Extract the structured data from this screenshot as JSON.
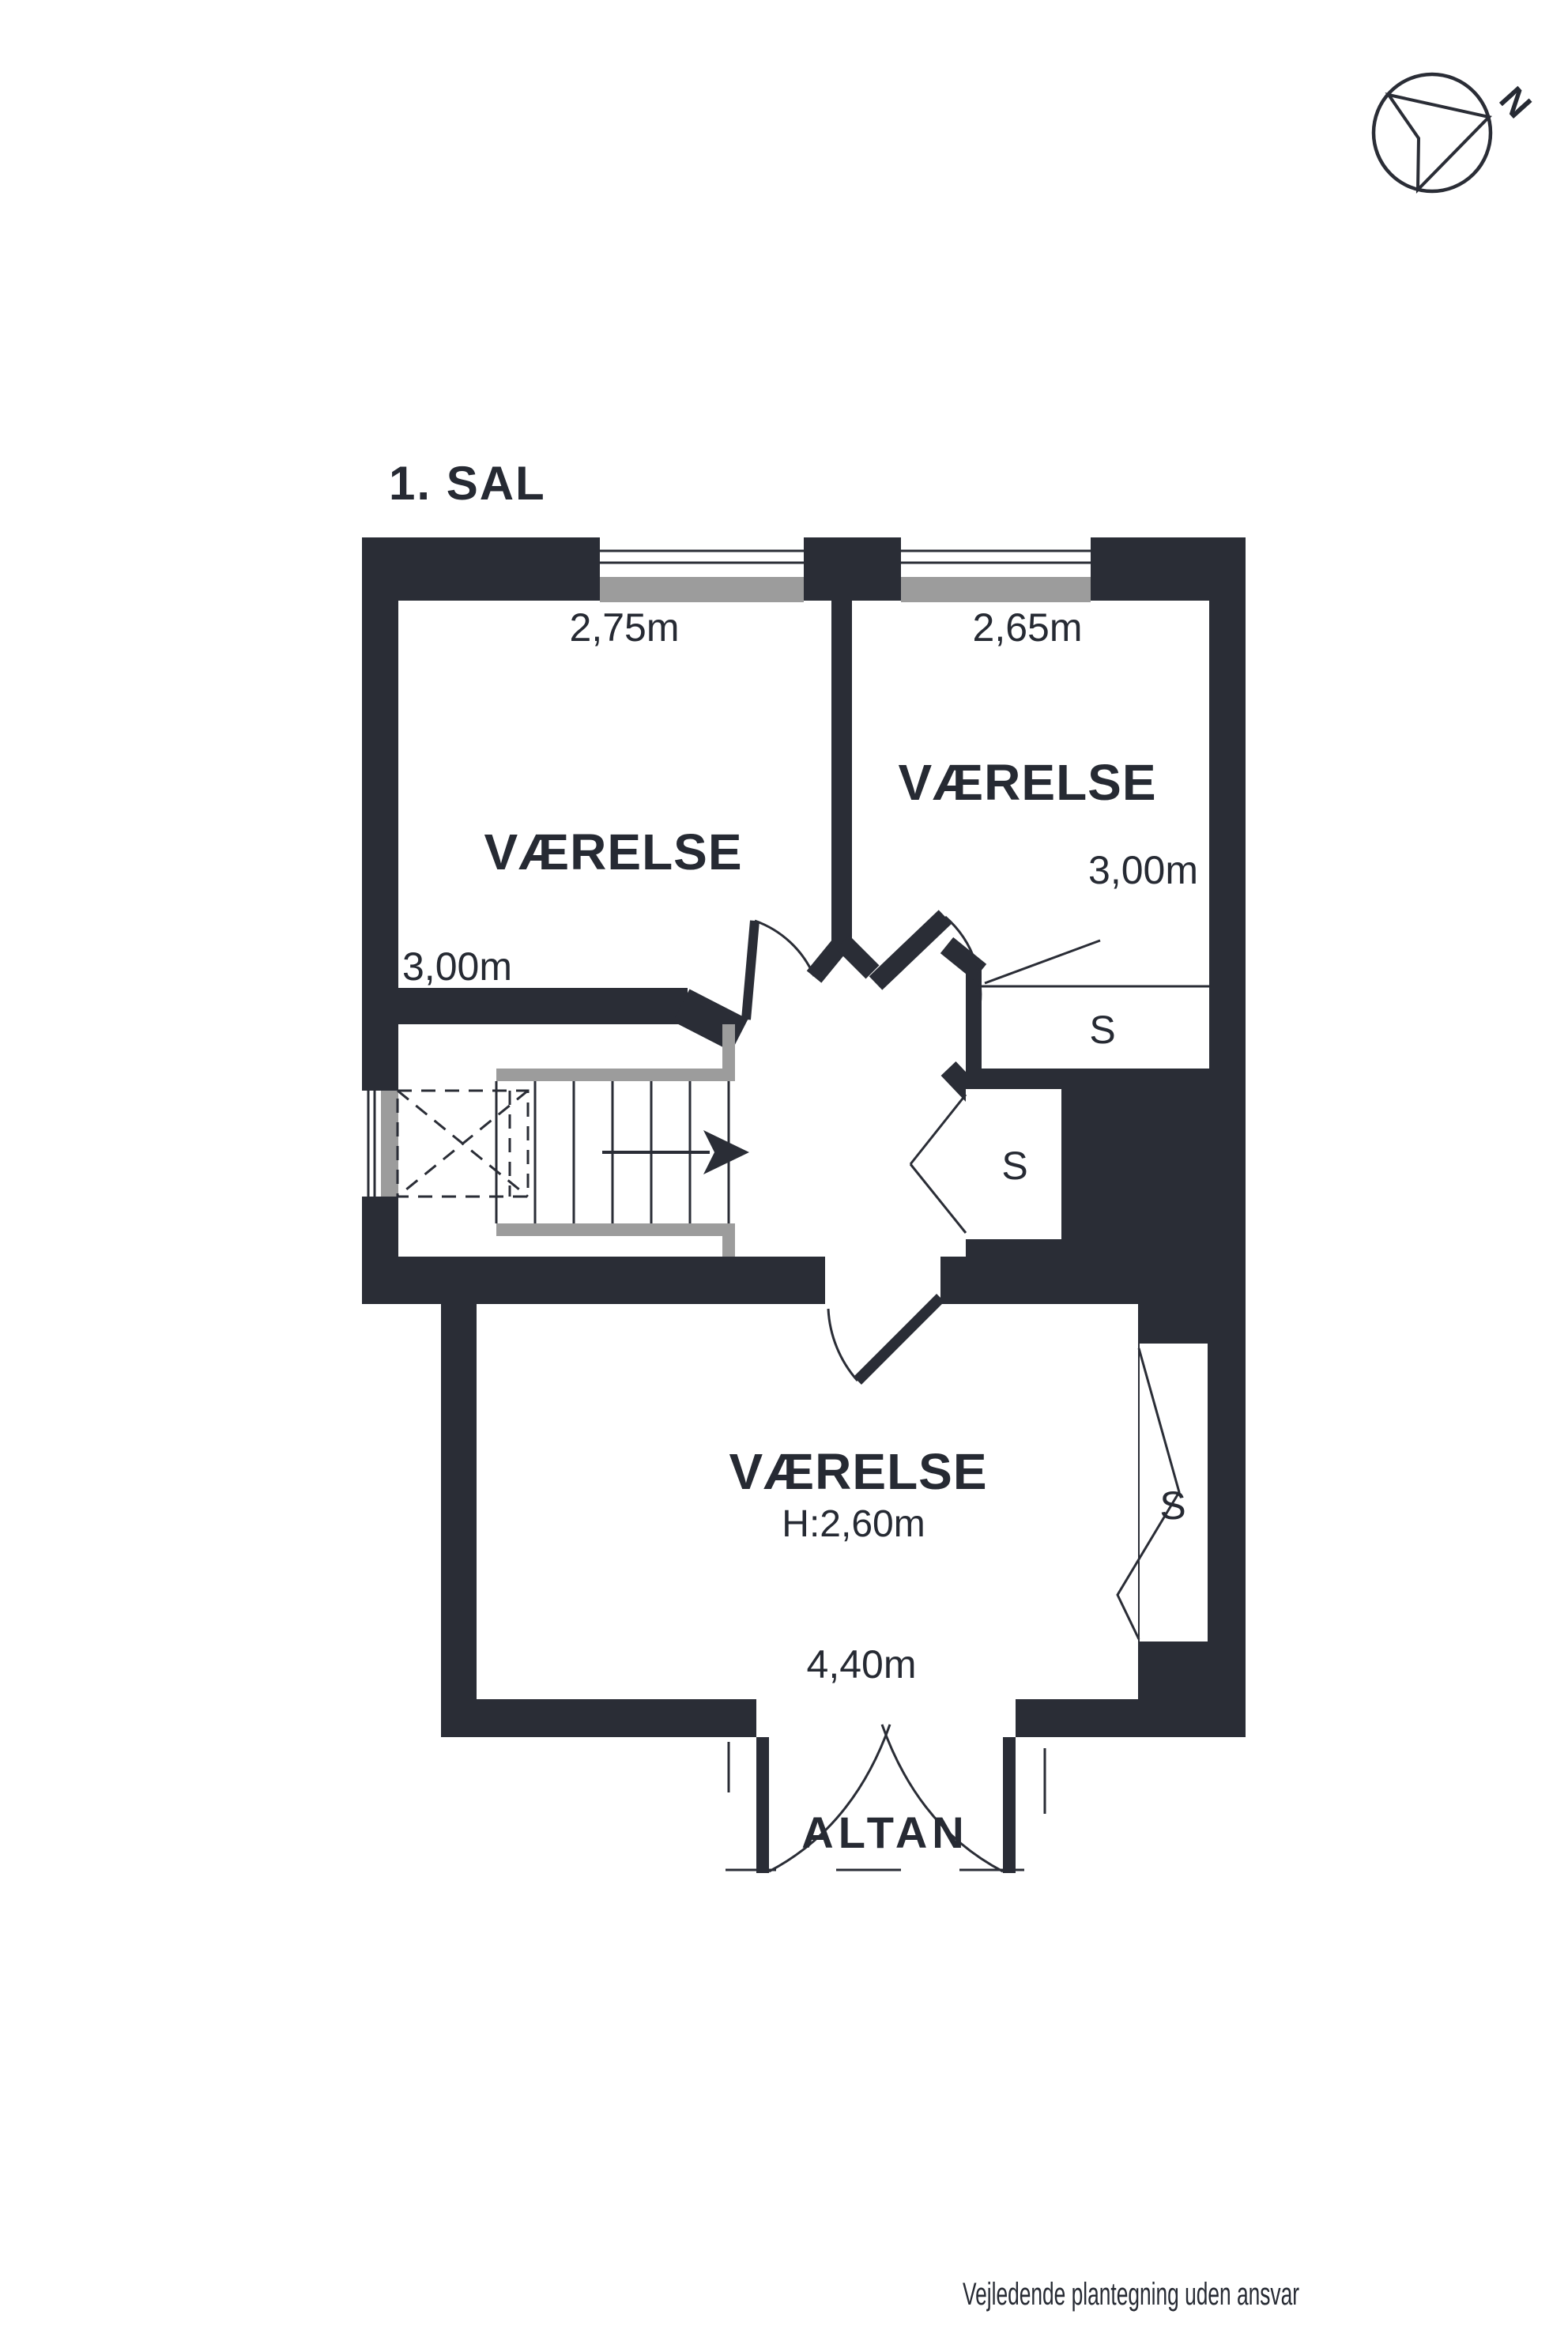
{
  "title": "1. SAL",
  "compass": {
    "north_label": "N"
  },
  "rooms": [
    {
      "name": "VÆRELSE",
      "width": "2,75m",
      "depth": "3,00m"
    },
    {
      "name": "VÆRELSE",
      "width": "2,65m",
      "depth": "3,00m"
    },
    {
      "name": "VÆRELSE",
      "ceiling_height": "H:2,60m",
      "width": "4,40m"
    }
  ],
  "closets": [
    {
      "label": "S"
    },
    {
      "label": "S"
    },
    {
      "label": "S"
    }
  ],
  "balcony": {
    "label": "ALTAN"
  },
  "footer": {
    "disclaimer": "Vejledende plantegning uden ansvar"
  },
  "colors": {
    "wall": "#2a2d36",
    "stair_gray": "#9c9c9c",
    "text": "#262a33",
    "background": "#ffffff"
  }
}
